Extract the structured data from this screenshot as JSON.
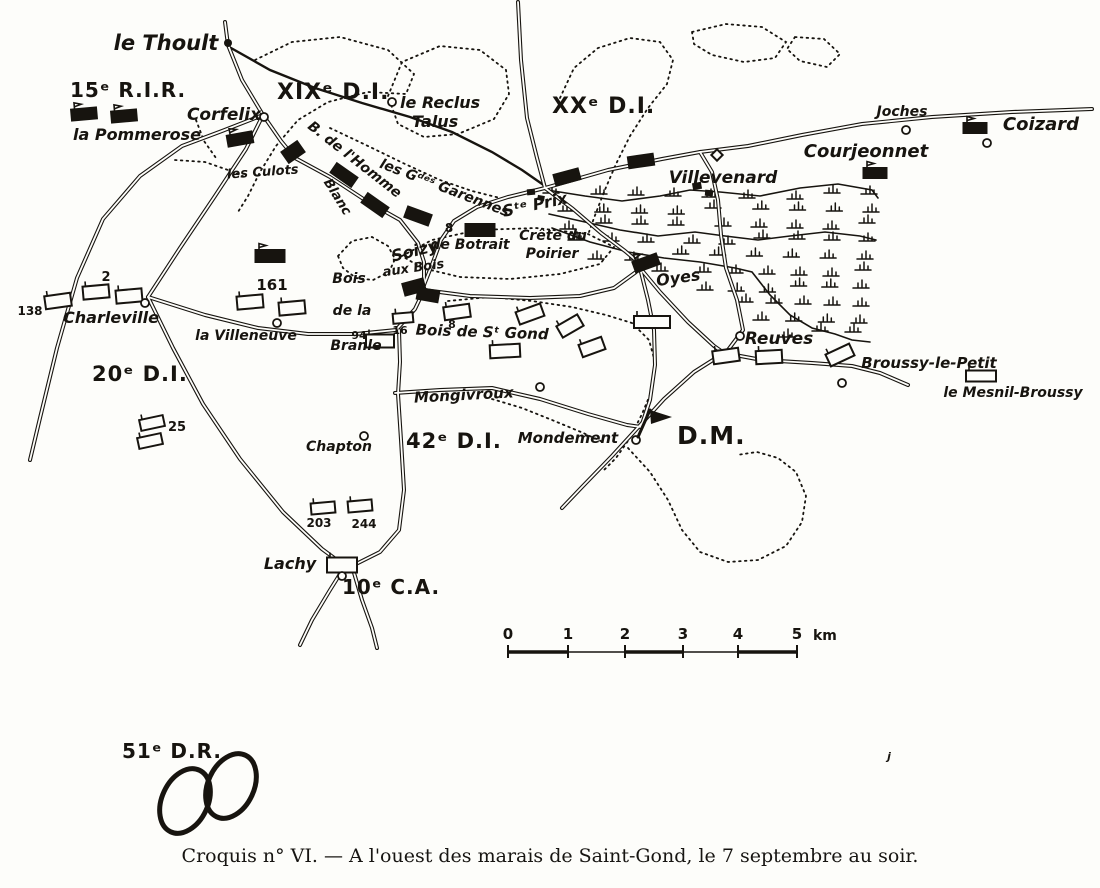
{
  "caption": "Croquis n° VI. — A l'ouest des marais de Saint-Gond, le 7 septembre au soir.",
  "colors": {
    "ink": "#17140f",
    "paper": "#fdfdfa"
  },
  "scale_bar": {
    "unit_label": "km",
    "tick_labels": [
      "0",
      "1",
      "2",
      "3",
      "4",
      "5"
    ]
  },
  "map": {
    "division_labels": [
      {
        "text": "15ᵉ R.I.R.",
        "x": 70,
        "y": 97,
        "size": 20
      },
      {
        "text": "XIXᵉ D.I.",
        "x": 277,
        "y": 99,
        "size": 22
      },
      {
        "text": "XXᵉ D.I.",
        "x": 552,
        "y": 113,
        "size": 22
      },
      {
        "text": "20ᵉ D.I.",
        "x": 92,
        "y": 381,
        "size": 21
      },
      {
        "text": "42ᵉ D.I.",
        "x": 406,
        "y": 448,
        "size": 21
      },
      {
        "text": "D.M.",
        "x": 677,
        "y": 444,
        "size": 25
      },
      {
        "text": "10ᵉ C.A.",
        "x": 342,
        "y": 594,
        "size": 20
      },
      {
        "text": "51ᵉ D.R.",
        "x": 122,
        "y": 758,
        "size": 20
      }
    ],
    "place_labels": [
      {
        "text": "le Thoult",
        "x": 166,
        "y": 50,
        "size": 21
      },
      {
        "text": "Corfelix",
        "x": 224,
        "y": 120,
        "size": 17
      },
      {
        "text": "la Pommerose",
        "x": 137,
        "y": 140,
        "size": 16
      },
      {
        "text": "le Reclus",
        "x": 400,
        "y": 108,
        "size": 16,
        "anchor": "start"
      },
      {
        "text": "Talus",
        "x": 412,
        "y": 127,
        "size": 16,
        "anchor": "start"
      },
      {
        "text": "Joches",
        "x": 902,
        "y": 116,
        "size": 14
      },
      {
        "text": "Coizard",
        "x": 1041,
        "y": 130,
        "size": 18
      },
      {
        "text": "Courjeonnet",
        "x": 866,
        "y": 157,
        "size": 18
      },
      {
        "text": "Villevenard",
        "x": 723,
        "y": 183,
        "size": 17
      },
      {
        "text": "les Culots",
        "x": 263,
        "y": 176,
        "size": 13,
        "rot": -4
      },
      {
        "text": "B. de l'Homme",
        "x": 352,
        "y": 163,
        "size": 14,
        "rot": 38
      },
      {
        "text": "Blanc",
        "x": 334,
        "y": 199,
        "size": 13,
        "rot": 58
      },
      {
        "text": "les Gᵈᵉˢ Garennes",
        "x": 443,
        "y": 192,
        "size": 14,
        "rot": 21
      },
      {
        "text": "Sᵗᵉ Prix",
        "x": 536,
        "y": 210,
        "size": 16,
        "rot": -12
      },
      {
        "text": "de Botrait",
        "x": 470,
        "y": 249,
        "size": 14
      },
      {
        "text": "Crête du",
        "x": 553,
        "y": 240,
        "size": 14
      },
      {
        "text": "Poirier",
        "x": 552,
        "y": 258,
        "size": 14
      },
      {
        "text": "Soizy",
        "x": 416,
        "y": 256,
        "size": 16,
        "rot": -14
      },
      {
        "text": "aux Bois",
        "x": 414,
        "y": 272,
        "size": 13,
        "rot": -8
      },
      {
        "text": "Bois",
        "x": 349,
        "y": 283,
        "size": 14
      },
      {
        "text": "de la",
        "x": 352,
        "y": 315,
        "size": 14
      },
      {
        "text": "Branle",
        "x": 356,
        "y": 350,
        "size": 14
      },
      {
        "text": "Bois de Sᵗ Gond",
        "x": 482,
        "y": 337,
        "size": 15,
        "rot": 2
      },
      {
        "text": "la Villeneuve",
        "x": 246,
        "y": 340,
        "size": 14
      },
      {
        "text": "Charleville",
        "x": 111,
        "y": 323,
        "size": 16
      },
      {
        "text": "Mongivroux",
        "x": 464,
        "y": 400,
        "size": 15,
        "rot": -3
      },
      {
        "text": "Mondement",
        "x": 568,
        "y": 443,
        "size": 15
      },
      {
        "text": "Chapton",
        "x": 339,
        "y": 451,
        "size": 14
      },
      {
        "text": "Lachy",
        "x": 290,
        "y": 569,
        "size": 16
      },
      {
        "text": "Oyes",
        "x": 679,
        "y": 283,
        "size": 16,
        "rot": -8
      },
      {
        "text": "Reuves",
        "x": 779,
        "y": 344,
        "size": 17
      },
      {
        "text": "Broussy-le-Petit",
        "x": 929,
        "y": 368,
        "size": 15
      },
      {
        "text": "le Mesnil-Broussy",
        "x": 1013,
        "y": 397,
        "size": 14
      },
      {
        "text": "j",
        "x": 889,
        "y": 760,
        "size": 11
      }
    ],
    "number_labels": [
      {
        "text": "138",
        "x": 30,
        "y": 315,
        "size": 12
      },
      {
        "text": "2",
        "x": 106,
        "y": 281,
        "size": 13
      },
      {
        "text": "161",
        "x": 272,
        "y": 290,
        "size": 15
      },
      {
        "text": "94",
        "x": 359,
        "y": 339,
        "size": 11
      },
      {
        "text": "16",
        "x": 400,
        "y": 334,
        "size": 11
      },
      {
        "text": "8",
        "x": 449,
        "y": 232,
        "size": 12
      },
      {
        "text": "8",
        "x": 452,
        "y": 328,
        "size": 11
      },
      {
        "text": "25",
        "x": 177,
        "y": 431,
        "size": 13
      },
      {
        "text": "203",
        "x": 319,
        "y": 527,
        "size": 12
      },
      {
        "text": "244",
        "x": 364,
        "y": 528,
        "size": 12
      }
    ],
    "black_units": [
      {
        "x": 84,
        "y": 114,
        "r": -5,
        "flag": true
      },
      {
        "x": 124,
        "y": 116,
        "r": -5,
        "flag": true
      },
      {
        "x": 240,
        "y": 139,
        "r": -10,
        "flag": true
      },
      {
        "x": 293,
        "y": 152,
        "r": -35,
        "w": 20,
        "h": 14
      },
      {
        "x": 344,
        "y": 175,
        "r": 35
      },
      {
        "x": 375,
        "y": 205,
        "r": 35
      },
      {
        "x": 418,
        "y": 216,
        "r": 20
      },
      {
        "x": 480,
        "y": 230,
        "r": 0,
        "w": 30,
        "h": 13
      },
      {
        "x": 270,
        "y": 256,
        "r": 0,
        "w": 30,
        "h": 13,
        "flag": true
      },
      {
        "x": 567,
        "y": 177,
        "r": -15
      },
      {
        "x": 641,
        "y": 161,
        "r": -8
      },
      {
        "x": 875,
        "y": 173,
        "r": 0,
        "w": 24,
        "h": 11,
        "flag": true
      },
      {
        "x": 975,
        "y": 128,
        "r": 0,
        "w": 24,
        "h": 11,
        "flag": true
      },
      {
        "x": 646,
        "y": 263,
        "r": -20,
        "flag": true
      },
      {
        "x": 414,
        "y": 287,
        "r": -15,
        "w": 22,
        "h": 13
      },
      {
        "x": 428,
        "y": 295,
        "r": 10,
        "w": 22,
        "h": 12
      }
    ],
    "white_units": [
      {
        "x": 58,
        "y": 301,
        "r": -8
      },
      {
        "x": 96,
        "y": 292,
        "r": -5
      },
      {
        "x": 129,
        "y": 296,
        "r": -5
      },
      {
        "x": 250,
        "y": 302,
        "r": -5
      },
      {
        "x": 292,
        "y": 308,
        "r": -5
      },
      {
        "x": 380,
        "y": 341,
        "r": 0,
        "w": 28
      },
      {
        "x": 403,
        "y": 318,
        "r": -5,
        "w": 20,
        "h": 10
      },
      {
        "x": 457,
        "y": 312,
        "r": -8
      },
      {
        "x": 530,
        "y": 314,
        "r": -20
      },
      {
        "x": 570,
        "y": 326,
        "r": -30,
        "w": 24
      },
      {
        "x": 592,
        "y": 347,
        "r": -20,
        "w": 24
      },
      {
        "x": 505,
        "y": 351,
        "r": -3,
        "w": 30
      },
      {
        "x": 652,
        "y": 322,
        "r": 0,
        "w": 36,
        "h": 12
      },
      {
        "x": 726,
        "y": 356,
        "r": -8
      },
      {
        "x": 769,
        "y": 357,
        "r": -3
      },
      {
        "x": 840,
        "y": 355,
        "r": -25
      },
      {
        "x": 981,
        "y": 376,
        "r": 0,
        "w": 30,
        "h": 11
      },
      {
        "x": 152,
        "y": 423,
        "r": -12,
        "w": 24,
        "h": 11
      },
      {
        "x": 150,
        "y": 441,
        "r": -12,
        "w": 24,
        "h": 11
      },
      {
        "x": 323,
        "y": 508,
        "r": -5,
        "w": 24,
        "h": 11
      },
      {
        "x": 360,
        "y": 506,
        "r": -5,
        "w": 24,
        "h": 11
      },
      {
        "x": 342,
        "y": 565,
        "r": 0,
        "w": 30,
        "h": 15
      }
    ],
    "rings": [
      {
        "x": 264,
        "y": 117
      },
      {
        "x": 392,
        "y": 102
      },
      {
        "x": 906,
        "y": 130
      },
      {
        "x": 987,
        "y": 143
      },
      {
        "x": 277,
        "y": 323
      },
      {
        "x": 145,
        "y": 303
      },
      {
        "x": 540,
        "y": 387
      },
      {
        "x": 636,
        "y": 440
      },
      {
        "x": 364,
        "y": 436
      },
      {
        "x": 342,
        "y": 576
      },
      {
        "x": 740,
        "y": 336
      },
      {
        "x": 842,
        "y": 383
      }
    ],
    "dots": [
      {
        "x": 228,
        "y": 43
      }
    ],
    "village_blocks": [
      {
        "x": 697,
        "y": 186,
        "w": 9,
        "h": 7,
        "r": -10
      },
      {
        "x": 709,
        "y": 193,
        "w": 8,
        "h": 6,
        "r": 5
      },
      {
        "x": 531,
        "y": 192,
        "w": 8,
        "h": 6,
        "r": -5
      },
      {
        "x": 541,
        "y": 198,
        "w": 7,
        "h": 5,
        "r": 10
      }
    ],
    "diamond": {
      "x": 717,
      "y": 155
    },
    "flag": {
      "pole": [
        638,
        437,
        650,
        410
      ],
      "pennant": "650,410 672,417 651,424"
    },
    "ellipses": [
      {
        "cx": 185,
        "cy": 801,
        "rx": 23,
        "ry": 34,
        "rot": 25
      },
      {
        "cx": 231,
        "cy": 786,
        "rx": 23,
        "ry": 34,
        "rot": 25
      }
    ]
  }
}
